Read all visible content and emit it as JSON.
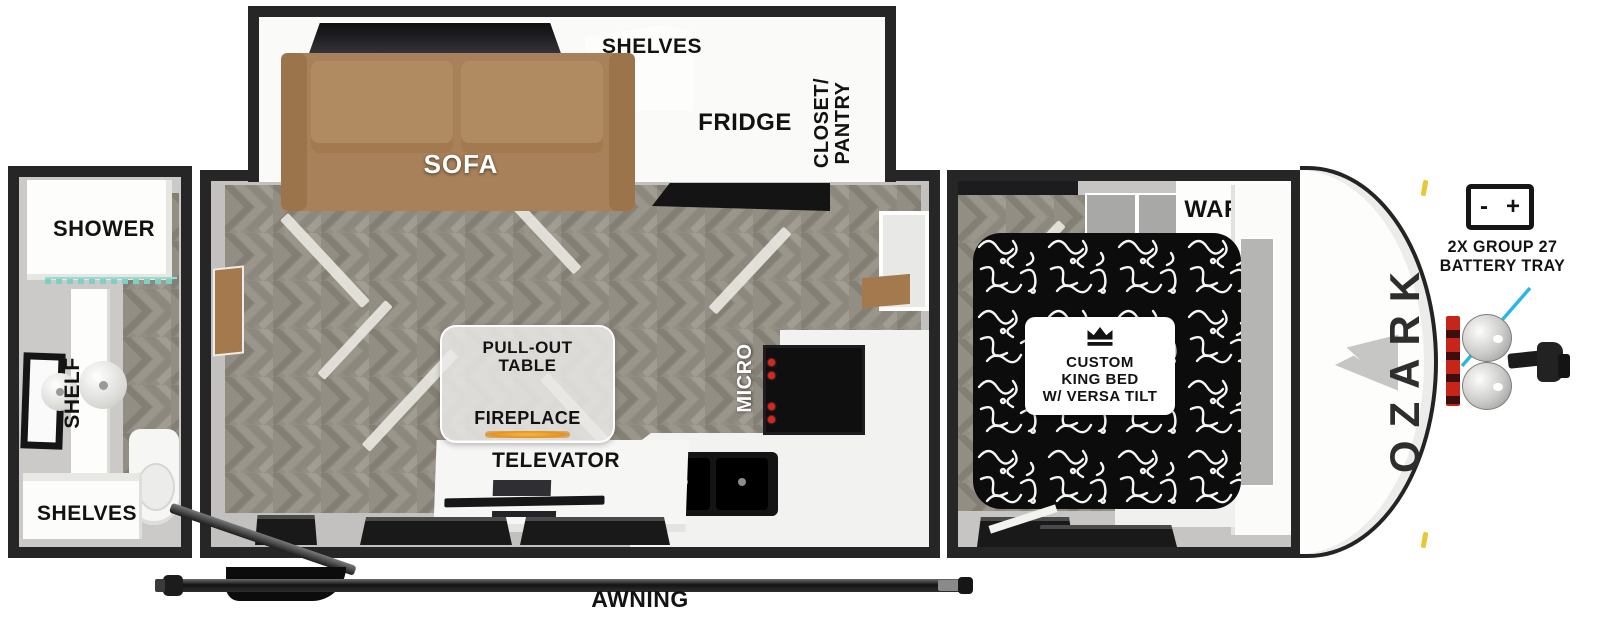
{
  "diagram": {
    "rear_bath": {
      "shower_label": "SHOWER",
      "shelf_label": "SHELF",
      "shelves_label": "SHELVES"
    },
    "slide_out": {
      "sofa_label": "SOFA",
      "shelves_label": "SHELVES",
      "fridge_label": "FRIDGE",
      "closet_label_line1": "CLOSET/",
      "closet_label_line2": "PANTRY"
    },
    "main_area": {
      "pullout_label_line1": "PULL-OUT",
      "pullout_label_line2": "TABLE",
      "fireplace_label": "FIREPLACE",
      "televator_label": "TELEVATOR",
      "micro_label": "MICRO"
    },
    "bedroom": {
      "ward_label": "WARD",
      "bed_label_line1": "CUSTOM",
      "bed_label_line2": "KING BED",
      "bed_label_line3": "W/ VERSA TILT"
    },
    "front_cap": {
      "brand": "OZARK"
    },
    "battery": {
      "icon_minus": "-",
      "icon_plus": "+",
      "label_line1": "2X GROUP 27",
      "label_line2": "BATTERY TRAY"
    },
    "awning_label": "AWNING",
    "colors": {
      "wall": "#262626",
      "floor": "#938e84",
      "sofa": "#a8815a",
      "accent_arrow": "#29b6e8",
      "flame": "#e8921c",
      "knob_red": "#d3281c",
      "clearance_light": "#e6c832"
    }
  }
}
